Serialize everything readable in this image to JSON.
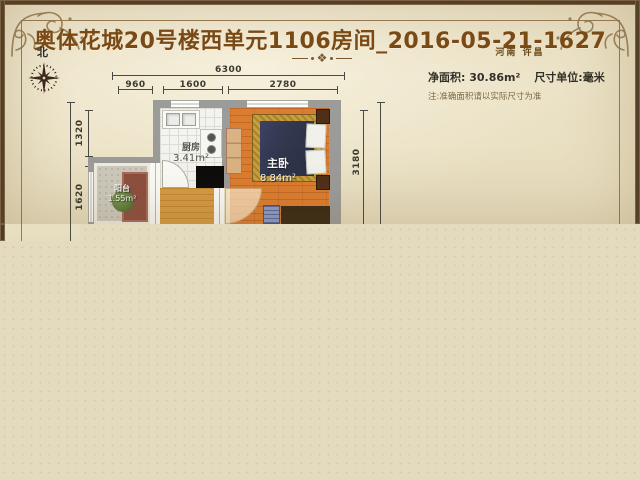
{
  "header": {
    "title": "奥体花城20号楼西单元1106房间_2016-05-21-1627",
    "location": "河南 许昌",
    "ornament": "❖"
  },
  "compass": {
    "north": "北"
  },
  "info": {
    "net_area": "净面积: 30.86m²",
    "unit": "尺寸单位:毫米",
    "note": "注:准确面积请以实际尺寸为准"
  },
  "plan": {
    "dims": {
      "total_width": "6300",
      "seg_960": "960",
      "seg_1600": "1600",
      "seg_2780": "2780",
      "seg_1320": "1320",
      "seg_1620": "1620",
      "seg_3180": "3180"
    },
    "rooms": {
      "kitchen": {
        "name": "厨房",
        "area": "3.41m²"
      },
      "bedroom": {
        "name": "主卧",
        "area": "8.84m²"
      },
      "balcony": {
        "name": "阳台",
        "area": "1.55m²"
      }
    }
  },
  "colors": {
    "paper": "#ebe1c4",
    "truncated_fill": "#e4dabd",
    "frame_dark": "#4f3c28",
    "title_brown": "#7b4a16",
    "wall_gray": "#9b9b99",
    "bedroom_wood": "#db7d30",
    "bed_navy": "#31374d",
    "bed_gold": "#c79e3c"
  }
}
